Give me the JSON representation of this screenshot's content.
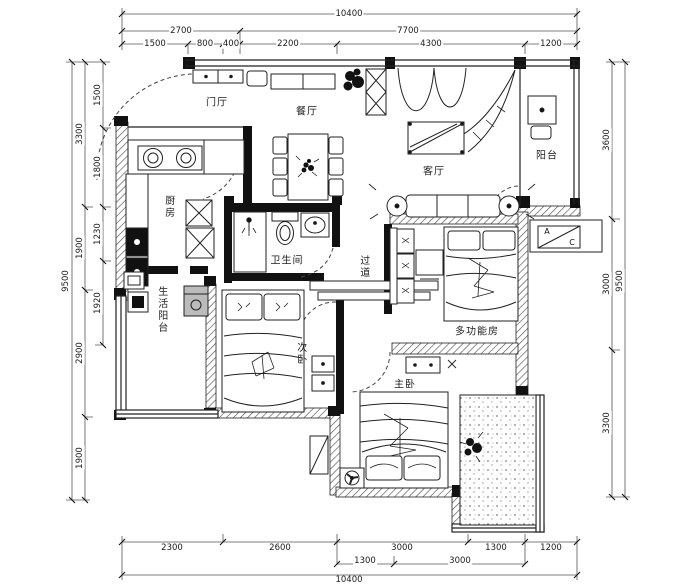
{
  "plan": {
    "rooms": {
      "entry": "门厅",
      "dining": "餐厅",
      "living": "客厅",
      "balcony": "阳台",
      "kitchen": "厨房",
      "bathroom": "卫生间",
      "corridor": "过道",
      "service_balcony": "生活阳台",
      "bedroom2": "次卧",
      "multi_room": "多功能房",
      "master": "主卧"
    },
    "ac_unit": {
      "a": "A",
      "c": "C"
    }
  },
  "dimensions": {
    "top": {
      "total": "10400",
      "row2": [
        "2700",
        "7700"
      ],
      "row3": [
        "1500",
        "800",
        "400",
        "2200",
        "4300",
        "1200"
      ]
    },
    "bottom": {
      "total": "10400",
      "row1": [
        "2300",
        "2600",
        "3000",
        "1300",
        "1200"
      ],
      "row2": [
        "1300",
        "3000"
      ]
    },
    "left": {
      "total": "9500",
      "outer": [
        "3300",
        "1900",
        "2900",
        "1900"
      ],
      "inner": [
        "1500",
        "1800",
        "1230",
        "1920"
      ]
    },
    "right": {
      "total": "9500",
      "inner": [
        "3600",
        "3000",
        "3300"
      ]
    }
  },
  "colors": {
    "line": "#1a1a1a",
    "wall": "#111111",
    "paper": "#ffffff"
  }
}
